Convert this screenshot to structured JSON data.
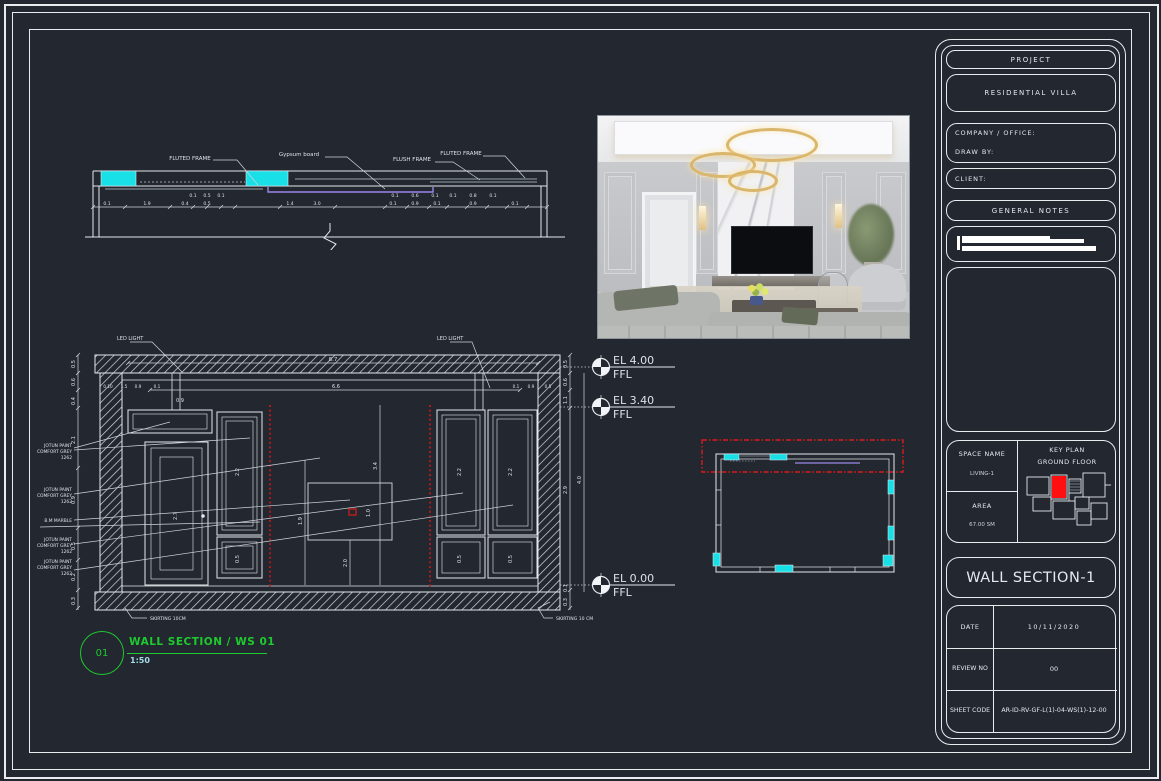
{
  "colors": {
    "background": "#232830",
    "line_white": "#e5e8ed",
    "accent_cyan": "#19e0e6",
    "accent_red": "#d81a1a",
    "accent_green": "#1ecb2e",
    "scale_cyan": "#a4dbe8",
    "accent_purple": "#9a86e8"
  },
  "title_block": {
    "project_label": "PROJECT",
    "project_name": "RESIDENTIAL VILLA",
    "company_label": "COMPANY / OFFICE:",
    "draw_by_label": "DRAW BY:",
    "client_label": "CLIENT:",
    "general_notes_label": "GENERAL NOTES",
    "space_name_label": "SPACE NAME",
    "space_name_value": "LIVING-1",
    "area_label": "AREA",
    "area_value": "67.00 SM",
    "key_plan_title": "KEY PLAN",
    "key_plan_subtitle": "GROUND FLOOR",
    "sheet_title": "WALL SECTION-1",
    "date_label": "DATE",
    "date_value": "10/11/2020",
    "review_label": "REVIEW NO",
    "review_value": "00",
    "sheet_code_label": "SHEET CODE",
    "sheet_code_value": "AR-ID-RV-GF-L(1)-04-WS(1)-12-00"
  },
  "callout": {
    "number": "01",
    "title": "WALL SECTION / WS 01",
    "scale": "1:50"
  },
  "levels": [
    {
      "el": "EL 4.00",
      "datum": "FFL"
    },
    {
      "el": "EL 3.40",
      "datum": "FFL"
    },
    {
      "el": "EL 0.00",
      "datum": "FFL"
    }
  ],
  "detail": {
    "labels": [
      "FLUTED FRAME",
      "Gypsum board",
      "FLUSH FRAME",
      "FLUTED FRAME"
    ]
  },
  "section": {
    "led_left": "LED LIGHT",
    "led_right": "LED LIGHT",
    "skirting_left": "SKIRTING 10CM",
    "skirting_right": "SKIRTING 10 CM",
    "marble_note": "B.M MARBLE",
    "finishes": [
      {
        "l1": "JOTUN PAINT",
        "l2": "COMFORT GREY",
        "l3": "1262"
      },
      {
        "l1": "JOTUN PAINT",
        "l2": "COMFORT GREY",
        "l3": "1262"
      },
      {
        "l1": "JOTUN PAINT",
        "l2": "COMFORT GREY",
        "l3": "1262"
      },
      {
        "l1": "JOTUN PAINT",
        "l2": "COMFORT GREY",
        "l3": "1262"
      }
    ]
  },
  "dims": {
    "detail_upper": [
      "0.1",
      "0.5",
      "0.1",
      "0.1",
      "0.6",
      "0.1",
      "0.1",
      "0.8",
      "0.1"
    ],
    "detail_lower": [
      "0.1",
      "1.9",
      "0.4",
      "0.5",
      "1.4",
      "3.0",
      "0.1",
      "0.9",
      "0.1",
      "0.9",
      "0.1"
    ],
    "section_top": [
      "8.7",
      "6.6",
      "0.10",
      "1.5",
      "0.9",
      "0.1",
      "0.1",
      "0.9",
      "0.5"
    ],
    "left_chain": [
      "0.5",
      "0.6",
      "0.4",
      "2.1",
      "0.9",
      "0.5",
      "0.2",
      "0.3"
    ],
    "right_chain": [
      "0.5",
      "0.6",
      "1.1",
      "4.0",
      "2.9",
      "0.1",
      "0.3"
    ],
    "panel": [
      "2.2",
      "2.7",
      "0.5",
      "1.9",
      "3.4",
      "1.0",
      "2.0",
      "2.2",
      "0.5",
      "2.2",
      "0.5",
      "0.9"
    ]
  }
}
